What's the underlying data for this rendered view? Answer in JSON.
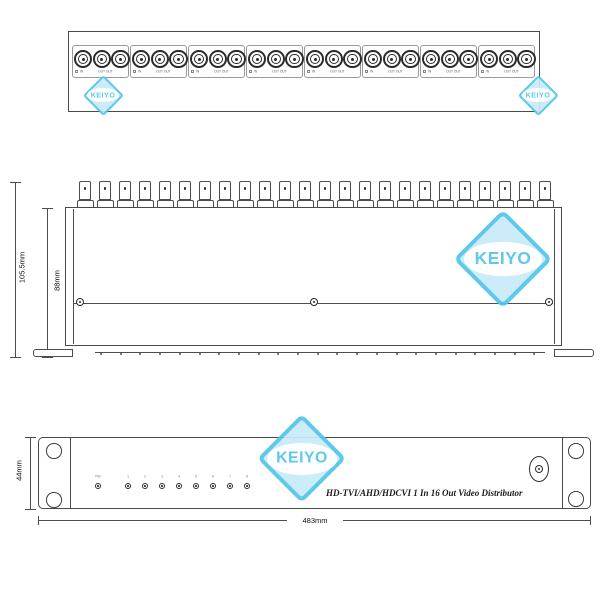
{
  "product": {
    "title_text": "HD-TVI/AHD/HDCVI  1 In 16 Out Video Distributor"
  },
  "brand": {
    "name": "KEIYO",
    "accent_color": "#52c5ea",
    "fill_color": "#c8ebf8"
  },
  "rear_top_view": {
    "group_count": 8,
    "connectors_per_group": 3,
    "in_label": "IN",
    "out_label": "OUT  OUT"
  },
  "side_view": {
    "connector_count": 24,
    "screw_count": 3,
    "height_overall": "105.5mm",
    "height_body": "88mm"
  },
  "front_view": {
    "power_led_label": "PW",
    "channel_led_labels": [
      "1",
      "2",
      "3",
      "4",
      "5",
      "6",
      "7",
      "8"
    ],
    "dc_jack_label": "DC12V",
    "dc_polarity": "-●+",
    "height": "44mm",
    "width": "483mm"
  }
}
